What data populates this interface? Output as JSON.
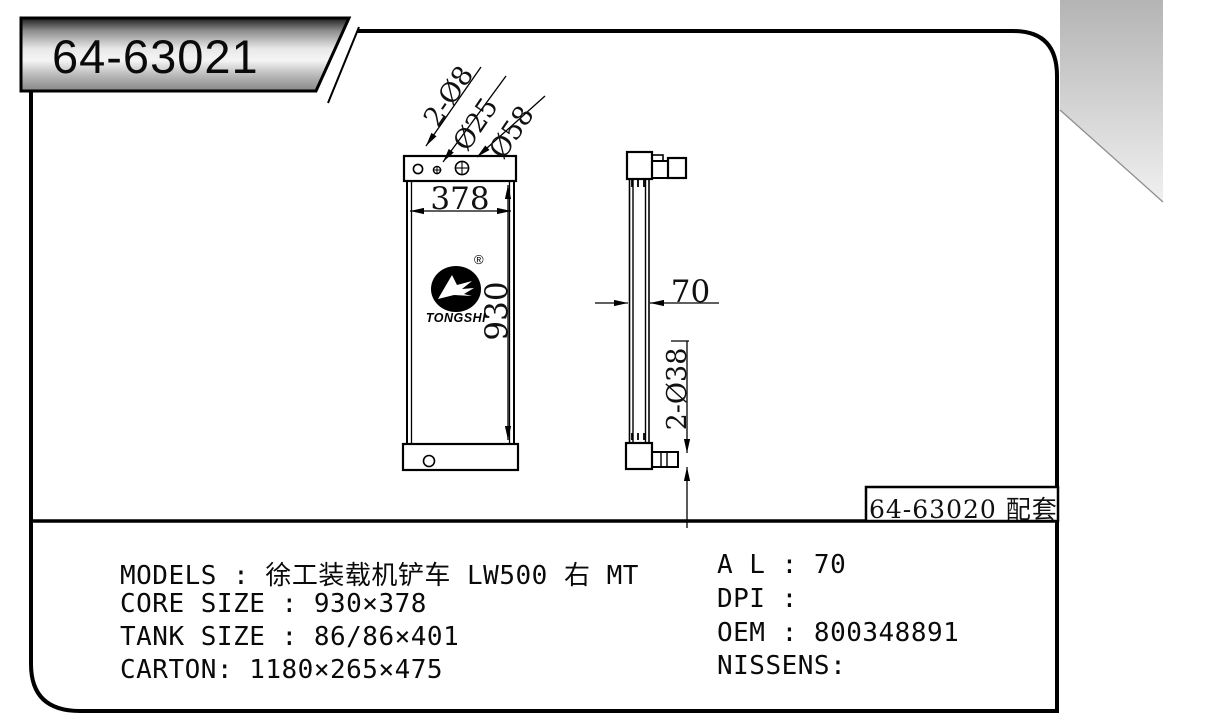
{
  "sheet": {
    "part_number": "64-63021",
    "paired_part_label": "64-63020 配套"
  },
  "front_view": {
    "width_dim": "378",
    "height_dim": "930",
    "port_label_small": "2-Ø8",
    "port_label_mid": "Ø25",
    "port_label_large": "Ø58",
    "logo_brand": "TONGSHI",
    "logo_registered": "®"
  },
  "side_view": {
    "depth_dim": "70",
    "pipe_dim": "2-Ø38"
  },
  "specs": {
    "left_lines": [
      "MODELS : 徐工装载机铲车 LW500 右 MT",
      "CORE SIZE : 930×378",
      "TANK SIZE : 86/86×401",
      "CARTON: 1180×265×475"
    ],
    "right_lines": [
      "A L : 70",
      "DPI :",
      "OEM : 800348891",
      "NISSENS:"
    ]
  },
  "colors": {
    "line": "#000000",
    "background": "#ffffff",
    "shade_top": "#b4b4b4",
    "shade_bottom": "#f0f0f0"
  }
}
